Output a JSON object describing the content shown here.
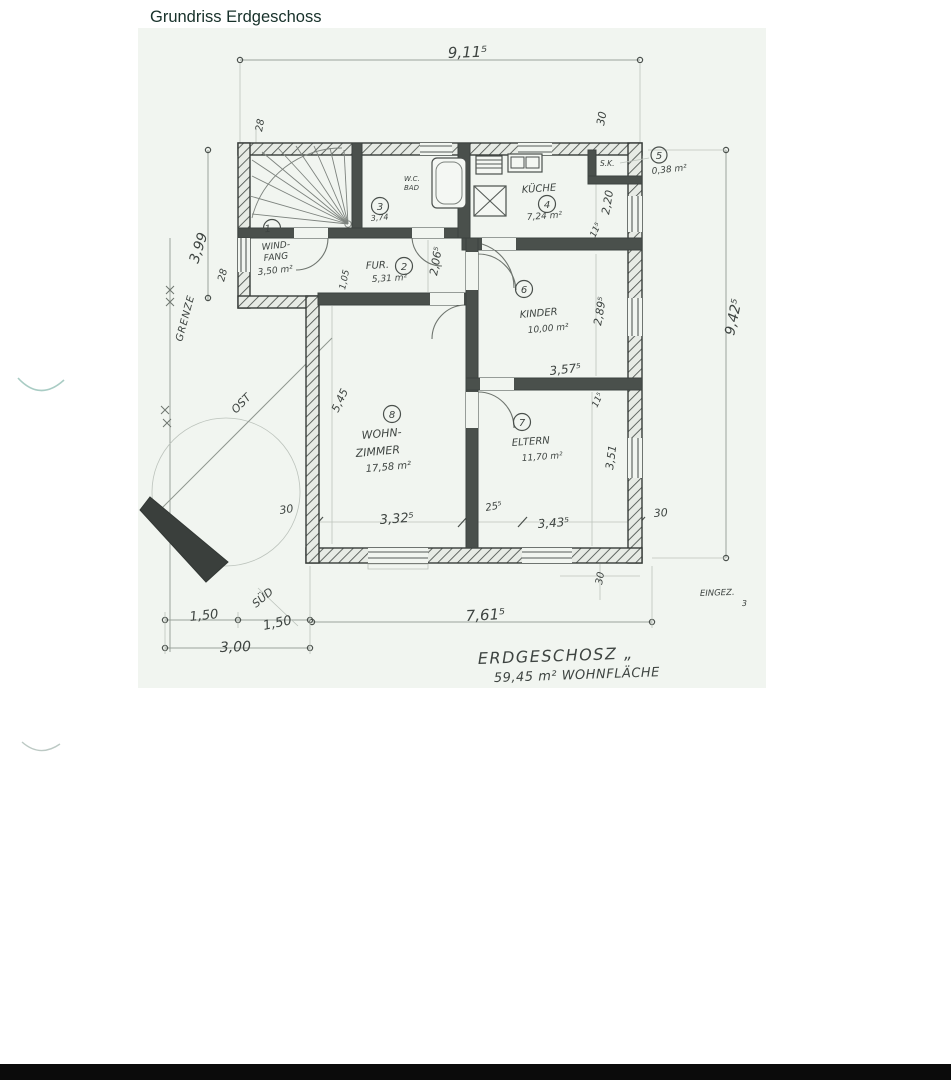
{
  "page": {
    "title": "Grundriss Erdgeschoss"
  },
  "plan": {
    "rooms": [
      {
        "num": "1",
        "line1": "WIND-",
        "line2": "FANG",
        "area": "3,50 m²"
      },
      {
        "num": "2",
        "name": "FUR.",
        "area": "5,31 m²"
      },
      {
        "num": "3",
        "line1": "W.C.",
        "line2": "BAD",
        "area": "3,74"
      },
      {
        "num": "4",
        "name": "KÜCHE",
        "area": "7,24 m²"
      },
      {
        "num": "5",
        "name": "S.K.",
        "area": "0,38 m²"
      },
      {
        "num": "6",
        "name": "KINDER",
        "area": "10,00 m²"
      },
      {
        "num": "7",
        "name": "ELTERN",
        "area": "11,70 m²"
      },
      {
        "num": "8",
        "line1": "WOHN-",
        "line2": "ZIMMER",
        "area": "17,58 m²"
      }
    ],
    "dims": {
      "top": "9,11⁵",
      "right": "9,42⁵",
      "bottom": "7,61⁵",
      "left_height": "3,99",
      "left_offset": "28",
      "top_offset": "28",
      "w_living": "3,32⁵",
      "w_mid": "25⁵",
      "w_parents": "3,43⁵",
      "wall_bl": "30",
      "wall_br": "30",
      "wall_tr": "30",
      "wall_bb": "30",
      "hall_h": "2,06⁵",
      "door_w": "1,05",
      "kinder_h": "2,89⁵",
      "kinder_w": "3,57⁵",
      "living_h": "5,45",
      "parents_h": "3,51",
      "off_a": "11⁵",
      "off_b": "11⁵",
      "pantry_h": "2,20",
      "b150a": "1,50",
      "b150b": "1,50",
      "b300": "3,00"
    },
    "labels": {
      "grenze": "GRENZE",
      "ost": "OST",
      "sued": "SÜD",
      "eingez": "EINGEZ.",
      "eingez2": "3"
    },
    "summary": {
      "line1": "ERDGESCHOSZ „",
      "line2": "59,45 m² WOHNFLÄCHE"
    }
  }
}
